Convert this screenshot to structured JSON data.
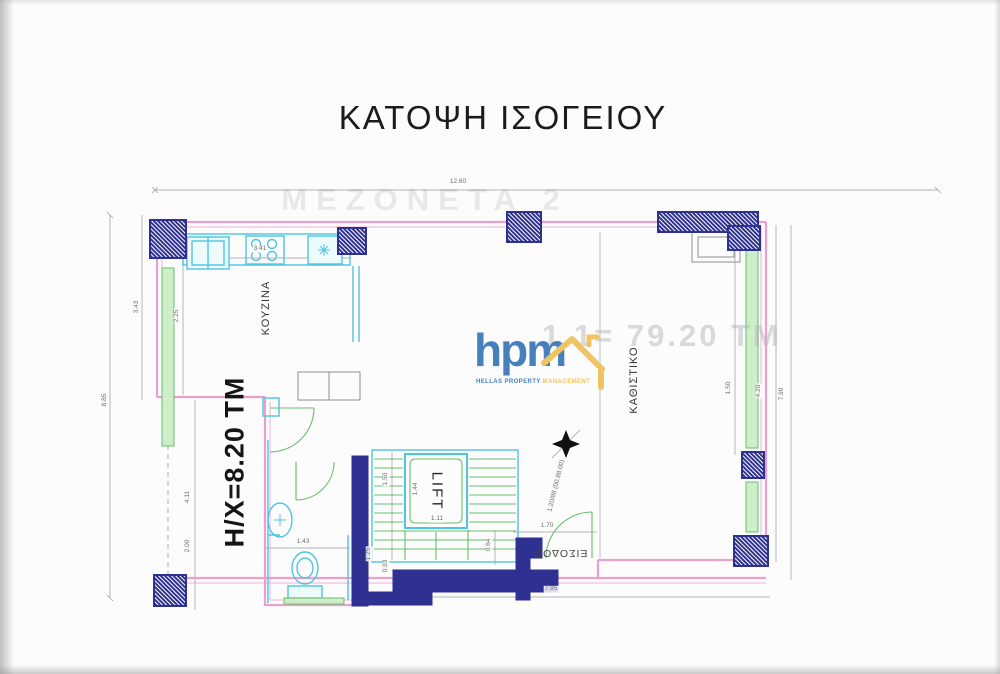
{
  "title": "ΚΑΤΟΨΗ ΙΣΟΓΕΙΟΥ",
  "watermarks": {
    "project": "ΜΕΖΟΝΕΤΑ 2",
    "area_note": "1.1= 79.20 ΤΜ"
  },
  "logo": {
    "monogram": "hpm",
    "caption": {
      "word1": "HELLAS",
      "word2": "PROPERTY",
      "word3": "MANAGEMENT"
    }
  },
  "rooms": {
    "kitchen": "ΚΟΥΖΙΝΑ",
    "living_room": "ΚΑΘΙΣΤΙΚΟ",
    "lift": "LIFT",
    "entrance": "ΕΙΣΟΔΟΣ",
    "covered_area": "H/X=8.20 TM"
  },
  "dimensions": [
    {
      "t": "12.60",
      "x": 458,
      "y": 182,
      "r": 0
    },
    {
      "t": "8.85",
      "x": 105,
      "y": 400,
      "r": -90
    },
    {
      "t": "3.43",
      "x": 137,
      "y": 307,
      "r": -90
    },
    {
      "t": "2.25",
      "x": 177,
      "y": 316,
      "r": -90
    },
    {
      "t": "3.41",
      "x": 260,
      "y": 249,
      "r": 0
    },
    {
      "t": "4.11",
      "x": 188,
      "y": 497,
      "r": -90
    },
    {
      "t": "2.00",
      "x": 188,
      "y": 546,
      "r": -90
    },
    {
      "t": "1.50",
      "x": 729,
      "y": 388,
      "r": -90
    },
    {
      "t": "4.20",
      "x": 759,
      "y": 391,
      "r": -90
    },
    {
      "t": "7.90",
      "x": 782,
      "y": 394,
      "r": -90
    },
    {
      "t": "7.95",
      "x": 551,
      "y": 589,
      "r": 0
    },
    {
      "t": "1.70",
      "x": 547,
      "y": 526,
      "r": 0
    },
    {
      "t": "1.50",
      "x": 386,
      "y": 479,
      "r": -90
    },
    {
      "t": "1.44",
      "x": 416,
      "y": 489,
      "r": -90
    },
    {
      "t": "1.11",
      "x": 437,
      "y": 519,
      "r": 0
    },
    {
      "t": "1.43",
      "x": 303,
      "y": 542,
      "r": 0
    },
    {
      "t": "0.64",
      "x": 489,
      "y": 545,
      "r": -90
    },
    {
      "t": "1.25",
      "x": 369,
      "y": 554,
      "r": -90
    },
    {
      "t": "0.93",
      "x": 386,
      "y": 566,
      "r": -90
    },
    {
      "t": "1.20/88 (00.88.00)",
      "x": 557,
      "y": 486,
      "r": -76
    }
  ],
  "colors": {
    "wall_pink": "#e9a0cd",
    "structure_navy": "#2e3191",
    "fixture_cyan": "#4fc4e1",
    "window_green": "#67bf6b",
    "window_green_fill": "#cdeec9",
    "dimension_gray": "#9a9a9a",
    "logo_blue": "#3f7ab8",
    "logo_yellow": "#eec25d"
  }
}
